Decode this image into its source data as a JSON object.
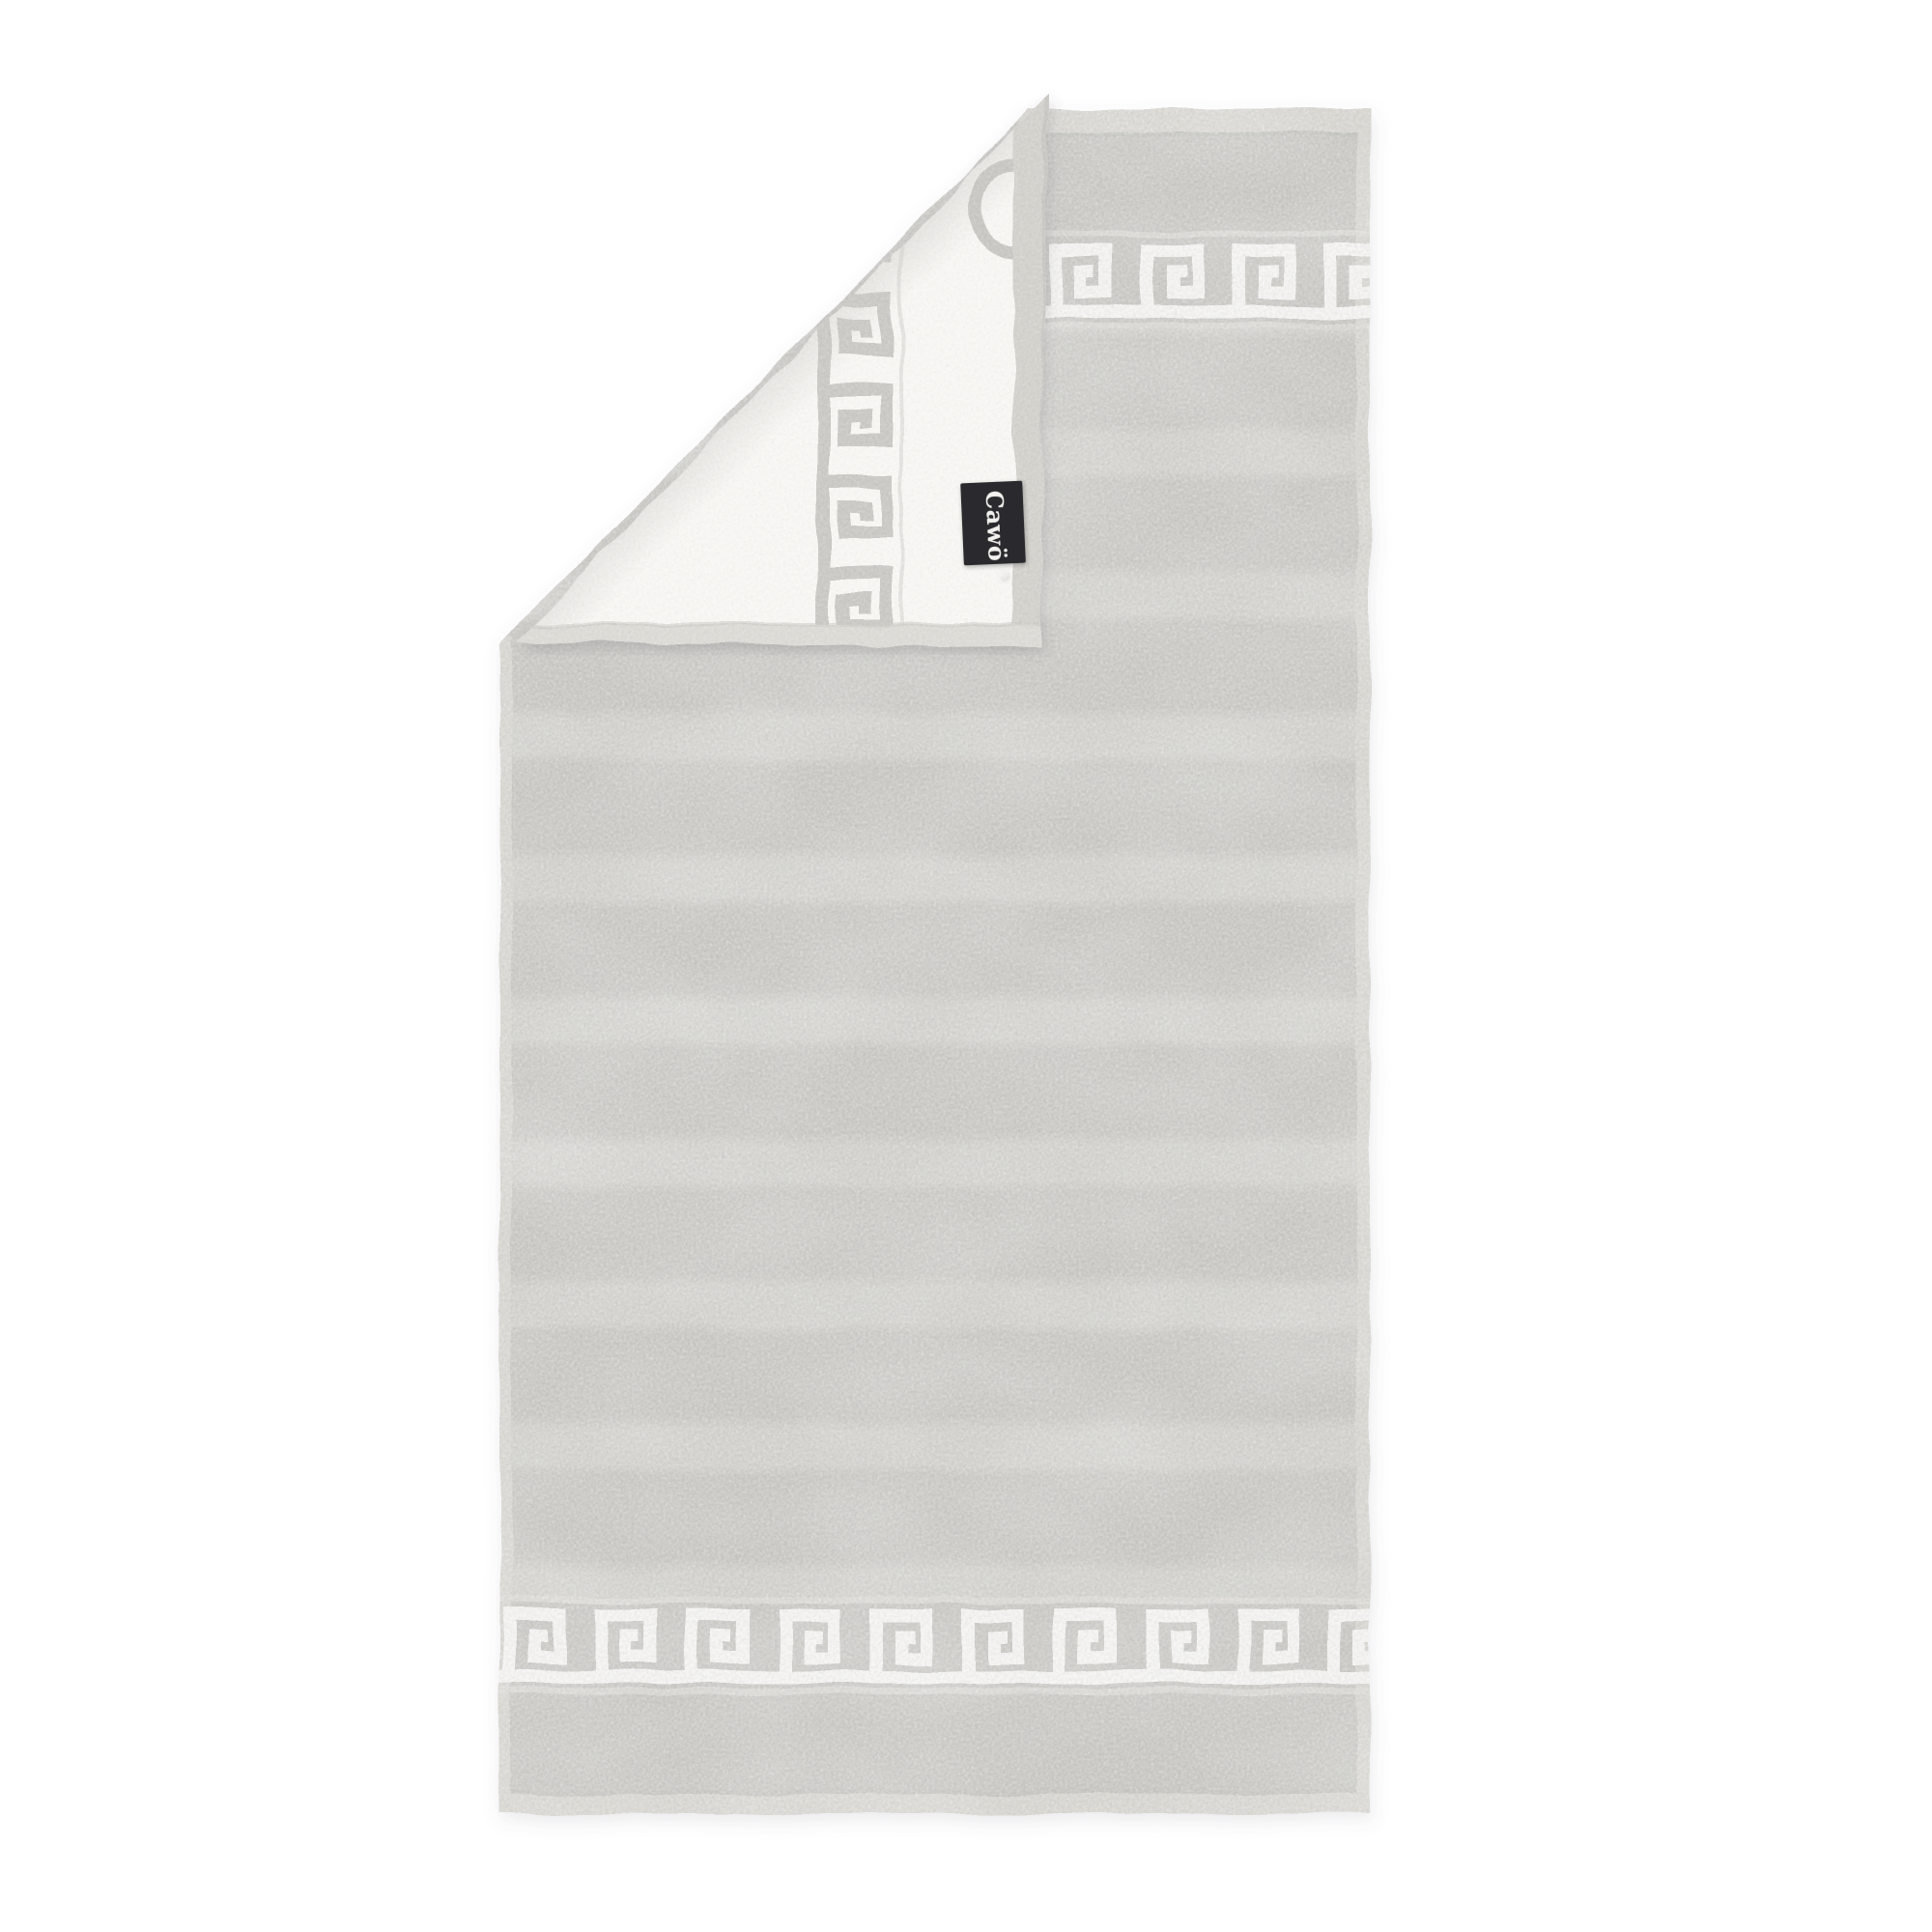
{
  "scene": {
    "description": "Studio product photo of a light grey terry bath towel hanging vertically on a white background. The towel has subtle tone-on-tone horizontal stripes and a white Greek key (meander) jacquard border near the top and bottom. The top-left corner is folded over to the front, revealing the white reverse side with the same meander border woven in grey, a partial circle motif, and a black woven brand label.",
    "background_color": "#ffffff"
  },
  "label": {
    "brand": "Cawö",
    "registered_mark": "®",
    "bg_color": "#2b2b2d",
    "text_color": "#f2f1ef"
  },
  "towel": {
    "front_base_color": "#c7c6c2",
    "stripe_light_color": "#d6d5d1",
    "hem_color": "#d7d5d0",
    "border_key_color": "#f4f3f1",
    "band_line_color": "#dcdbd7",
    "reverse_base_color": "#f8f7f4",
    "reverse_key_color": "#c9c7c3",
    "ring_color": "#c7c5c1",
    "fold_side_hem_color": "#d2d0cb",
    "fold_bottom_hem_color": "#dcdad5"
  }
}
